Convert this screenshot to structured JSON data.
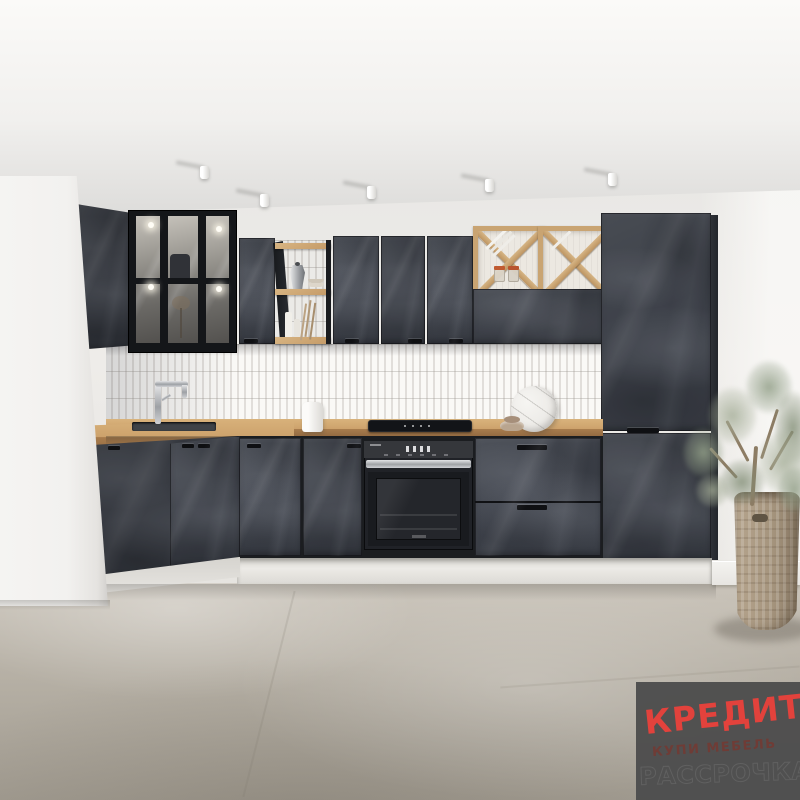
{
  "scene": {
    "description": "3D product render of an L-shaped kitchen with dark slate stone-effect fronts, oak worktop and open shelving, white kit-kat tile backsplash, built-in black oven and hob, tall pantry column, oak wine cube racks, olive tree in a wicker pot on a gray stone floor",
    "objects": [
      "ceiling spotlights",
      "glass display wall cabinet",
      "slate wall cabinets",
      "open oak shelf with moka pot, bowls, candles and dried flowers",
      "oak wine cube racks with jars and plates",
      "tall slate pantry cabinet",
      "oak worktop",
      "kit-kat tile backsplash",
      "stainless faucet and sink",
      "white kettle",
      "black hob",
      "built-in black oven",
      "drawer unit",
      "round marble serving board",
      "stoneware bowl",
      "olive tree in wicker basket pot",
      "marble-effect gray floor"
    ],
    "spotlight_count": 5,
    "wine_cube_count": 2
  },
  "badge": {
    "line1": "КРЕДИТ",
    "line2": "КУПИ МЕБЕЛЬ",
    "line3": "РАССРОЧКА",
    "background_color": "#4d4d4d",
    "line1_color": "#e2423c",
    "line2_color": "#6f3c36",
    "line3_color": "#606060"
  },
  "palette": {
    "cabinet_slate": "#454952",
    "cabinet_slate_dark": "#34373e",
    "oak_wood": "#cda26c",
    "tile_white": "#f4f2ee",
    "wall": "#edebe8",
    "ceiling": "#f6f5f3",
    "floor": "#b9b3a8",
    "appliance_black": "#202227",
    "stainless_steel": "#c3c6c9",
    "plant_green": "#93a089",
    "basket": "#ab9a83"
  }
}
